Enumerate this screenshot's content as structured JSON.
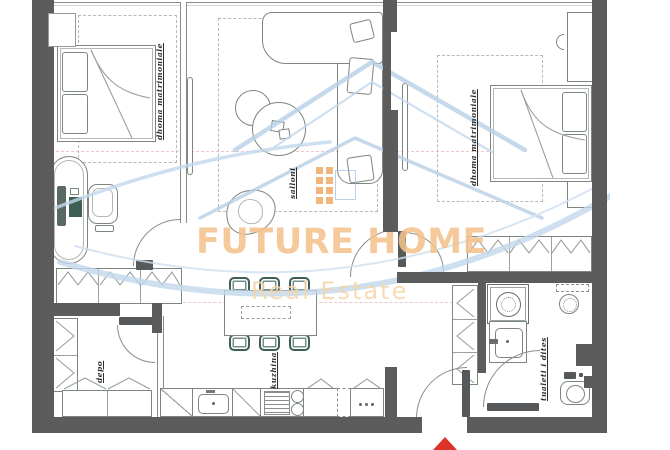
{
  "watermark": {
    "brand": "FUTURE HOME",
    "tagline": "Real Estate",
    "brand_color": "#f4c28b",
    "tagline_color": "#f6d5a7",
    "logo_blue": "#9cbedd",
    "logo_window_orange": "#f0a55c",
    "swoosh_blue": "#c3d8ec"
  },
  "rooms": [
    {
      "id": "bedroom-left",
      "label": "dhoma matrimoniale"
    },
    {
      "id": "living-room",
      "label": "salloni"
    },
    {
      "id": "bedroom-right",
      "label": "dhoma matrimoniale"
    },
    {
      "id": "storage",
      "label": "depo"
    },
    {
      "id": "kitchen",
      "label": "kuzhina"
    },
    {
      "id": "day-toilet",
      "label": "tualeti i dites"
    }
  ],
  "colors": {
    "wall": "#5c5c5c",
    "furniture_line": "#7d857f",
    "chair_teal": "#3f5f56",
    "entrance_arrow_red": "#dd3226",
    "guide_line_pink": "#ecb8b8"
  }
}
